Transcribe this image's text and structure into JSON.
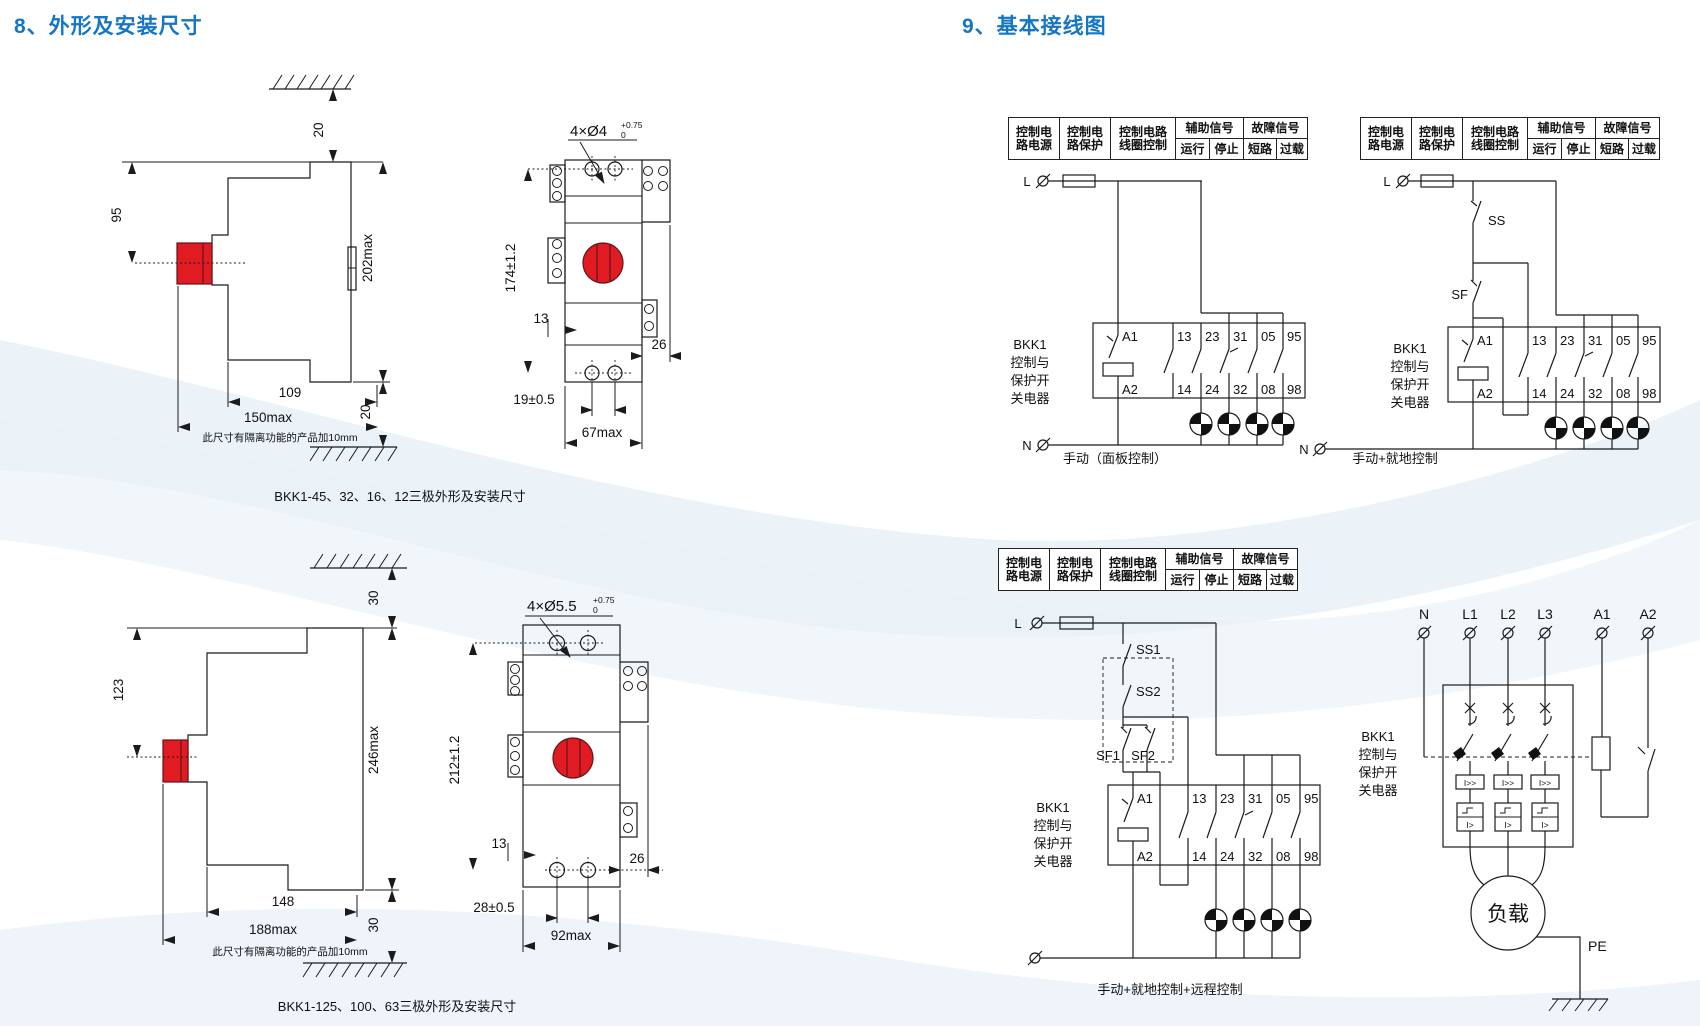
{
  "page": {
    "section8_title": "8、外形及安装尺寸",
    "section9_title": "9、基本接线图"
  },
  "colors": {
    "heading_blue": "#1576c5",
    "button_red": "#e01b22",
    "line_dark": "#1b1b1b"
  },
  "outline_drawings": {
    "small_side": {
      "top_gap": "20",
      "button_height": "95",
      "total_height": "202max",
      "body_width": "109",
      "total_width": "150max",
      "bottom_gap": "20",
      "note": "此尺寸有隔离功能的产品加10mm"
    },
    "small_front": {
      "holes": "4×Ø4",
      "tol_upper": "+0.75",
      "tol_lower": "0",
      "height": "174±1.2",
      "rail_offset": "13",
      "tab_width": "26",
      "hole_pitch": "19±0.5",
      "width": "67max"
    },
    "small_caption": "BKK1-45、32、16、12三极外形及安装尺寸",
    "large_side": {
      "top_gap": "30",
      "button_height": "123",
      "total_height": "246max",
      "body_width": "148",
      "total_width": "188max",
      "bottom_gap": "30",
      "note": "此尺寸有隔离功能的产品加10mm"
    },
    "large_front": {
      "holes": "4×Ø5.5",
      "tol_upper": "+0.75",
      "tol_lower": "0",
      "height": "212±1.2",
      "rail_offset": "13",
      "tab_width": "26",
      "hole_pitch": "28±0.5",
      "width": "92max"
    },
    "large_caption": "BKK1-125、100、63三极外形及安装尺寸"
  },
  "wiring": {
    "signal_table": {
      "col1_line1": "控制电",
      "col1_line2": "路电源",
      "col2_line1": "控制电",
      "col2_line2": "路保护",
      "col3_line1": "控制电路",
      "col3_line2": "线圈控制",
      "col4_header": "辅助信号",
      "col4_sub1": "运行",
      "col4_sub2": "停止",
      "col5_header": "故障信号",
      "col5_sub1": "短路",
      "col5_sub2": "过载"
    },
    "device_label": [
      "BKK1",
      "控制与",
      "保护开",
      "关电器"
    ],
    "terminals_top": [
      "A1",
      "13",
      "23",
      "31",
      "05",
      "95"
    ],
    "terminals_bottom": [
      "A2",
      "14",
      "24",
      "32",
      "08",
      "98"
    ],
    "phase_l": "L",
    "phase_n": "N",
    "diagram1": {
      "caption": "手动（面板控制）"
    },
    "diagram2": {
      "stop_switch": "SS",
      "start_switch": "SF",
      "caption": "手动+就地控制"
    },
    "diagram3": {
      "stop1": "SS1",
      "stop2": "SS2",
      "start1": "SF1",
      "start2": "SF2",
      "caption": "手动+就地控制+远程控制"
    },
    "diagram4": {
      "terminals": [
        "N",
        "L1",
        "L2",
        "L3",
        "A1",
        "A2"
      ],
      "magnetic_trip": "I>>",
      "thermal_trip": "I>",
      "load": "负载",
      "earth": "PE"
    }
  }
}
